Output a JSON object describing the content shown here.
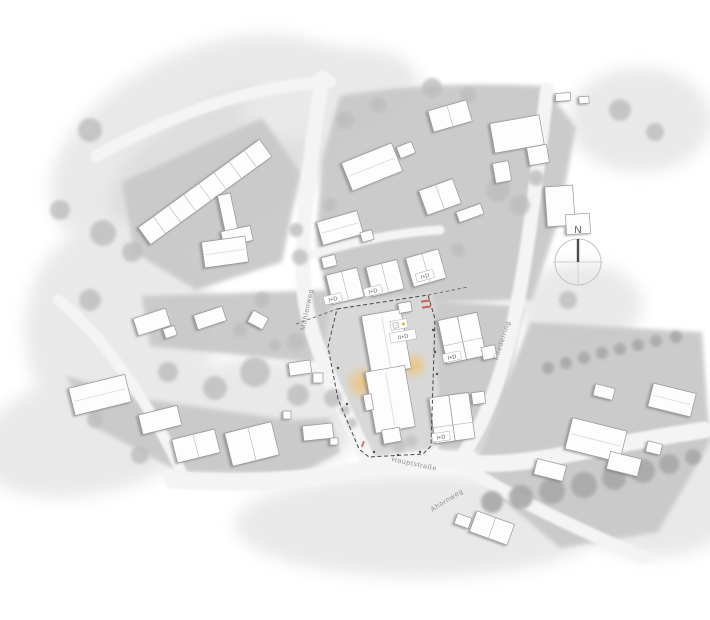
{
  "plan": {
    "compass": {
      "label": "N"
    },
    "streets": {
      "left": "Mühlenweg",
      "right": "Fliederring",
      "bottom": "Hauptstraße",
      "branch": "Ahornweg"
    },
    "labels": {
      "central_building": "II+D",
      "row_pair_a": "I+D",
      "row_pair_b": "I+D",
      "row_pair_c": "I+D",
      "semi_north": "I+D",
      "semi_south": "I+D"
    },
    "colors": {
      "parcel": "#c9c9c9",
      "parcel_light": "#d8d8d8",
      "road": "#f4f4f4",
      "building_fill": "#fdfdfd",
      "building_stroke": "#979797",
      "tree": "#bdbdbd",
      "tree_dark": "#a8a8a8",
      "entry_glow": "#f0c169",
      "boundary_dash": "#484848",
      "annotation_red": "#c45248"
    }
  }
}
